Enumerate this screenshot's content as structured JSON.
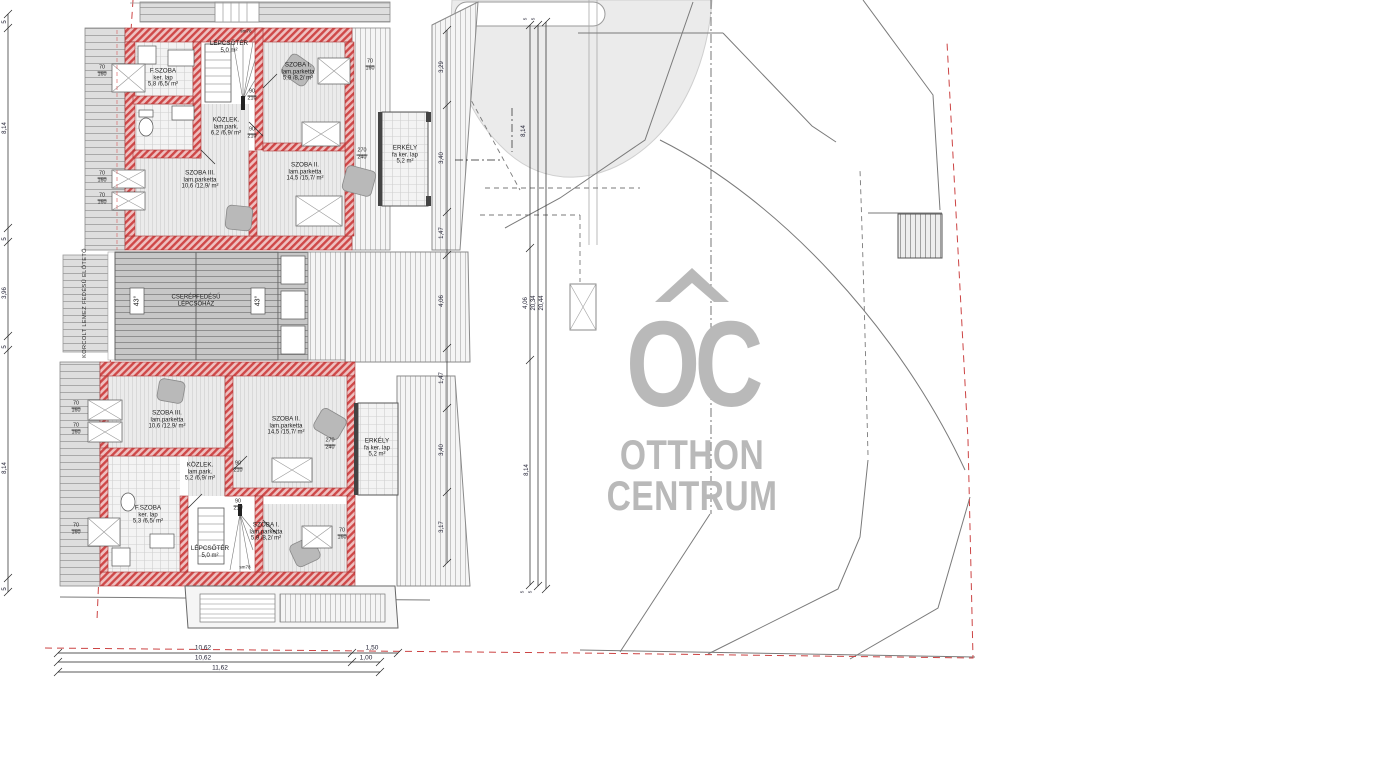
{
  "logo": {
    "monogram": "OC",
    "name_line1": "OTTHON",
    "name_line2": "CENTRUM",
    "color": "#b9b9b9"
  },
  "center_block": {
    "canopy_label": "KORCOLT LEMEZ FEDÉSŰ ELŐTETŐ",
    "roof_label_line1": "CSERÉPFEDÉSŰ",
    "roof_label_line2": "LÉPCSŐHÁZ",
    "roof_angle_left": "43°",
    "roof_angle_right": "43°"
  },
  "upper_unit": {
    "stair": {
      "name": "LÉPCSŐTÉR",
      "area": "5,0 m²",
      "headroom": "sm78"
    },
    "bathroom": {
      "name": "F.SZOBA",
      "finish": "ker. lap",
      "area": "5,8 /6,5/ m²"
    },
    "room1": {
      "name": "SZOBA I.",
      "finish": "lam.parketta",
      "area": "5,9 /8,2/ m²"
    },
    "hall": {
      "name": "KÖZLEK.",
      "finish": "lam.park.",
      "area": "6,2 /6,9/ m²"
    },
    "room3": {
      "name": "SZOBA III.",
      "finish": "lam.parketta",
      "area": "10,6 /12,9/ m²"
    },
    "room2": {
      "name": "SZOBA II.",
      "finish": "lam.parketta",
      "area": "14,5 /15,7/ m²"
    },
    "balcony": {
      "name": "ERKÉLY",
      "finish": "fa ker. lap",
      "area": "5,2 m²"
    }
  },
  "lower_unit": {
    "stair": {
      "name": "LÉPCSŐTÉR",
      "area": "5,0 m²",
      "headroom": "sm78"
    },
    "bathroom": {
      "name": "F.SZOBA",
      "finish": "ker. lap",
      "area": "5,3 /6,5/ m²"
    },
    "room1": {
      "name": "SZOBA I.",
      "finish": "lam.parketta",
      "area": "5,9 /8,2/ m²"
    },
    "hall": {
      "name": "KÖZLEK.",
      "finish": "lam.park.",
      "area": "5,2 /6,9/ m²"
    },
    "room3": {
      "name": "SZOBA III.",
      "finish": "lam.parketta",
      "area": "10,6 /12,9/ m²"
    },
    "room2": {
      "name": "SZOBA II.",
      "finish": "lam.parketta",
      "area": "14,5 /15,7/ m²"
    },
    "balcony": {
      "name": "ERKÉLY",
      "finish": "fa ker. lap",
      "area": "5,2 m²"
    }
  },
  "openings": {
    "window_w": "70",
    "window_h": "160",
    "door_w": "90",
    "door_h": "210",
    "balcony_door_w": "270",
    "balcony_door_h": "240"
  },
  "dimensions": {
    "left": [
      "5",
      "8,14",
      "5",
      "3,96",
      "5",
      "8,14",
      "5"
    ],
    "site_vertical": [
      "3,29",
      "3,40",
      "1,47",
      "4,06",
      "1,47",
      "3,40",
      "3,17"
    ],
    "right_top": "8,14",
    "right_totals": [
      "4,06",
      "20,34",
      "20,44"
    ],
    "right_bottom": "8,14",
    "right_small": [
      "5",
      "5",
      "5",
      "5"
    ],
    "bottom_row1": [
      "10,62",
      "1,50"
    ],
    "bottom_row2": [
      "10,62",
      "1,00"
    ],
    "bottom_row3": [
      "11,62"
    ]
  },
  "colors": {
    "wall_red": "#cf4848",
    "roof_gray": "#c7c7c7",
    "boundary_red": "#cc4444",
    "logo_gray": "#b9b9b9"
  }
}
